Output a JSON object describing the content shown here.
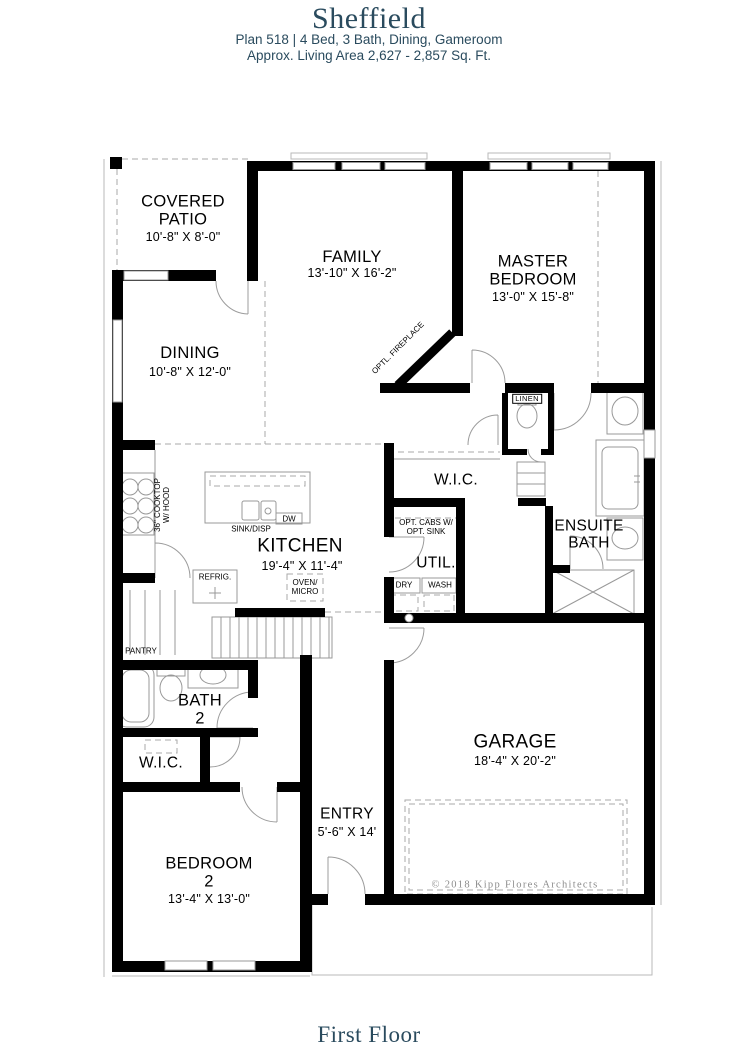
{
  "header": {
    "title": "Sheffield",
    "subtitle1": "Plan 518 | 4 Bed, 3 Bath, Dining, Gameroom",
    "subtitle2": "Approx. Living Area 2,627 - 2,857 Sq. Ft."
  },
  "footer": {
    "label": "First Floor"
  },
  "plan": {
    "copyright": "© 2018 Kipp Flores Architects",
    "colors": {
      "accent": "#2a4b5e",
      "wall": "#000000",
      "line": "#999999"
    },
    "rooms": {
      "covered_patio": {
        "name": "COVERED\nPATIO",
        "dims": "10'-8\" X 8'-0\""
      },
      "family": {
        "name": "FAMILY",
        "dims": "13'-10\" X 16'-2\""
      },
      "master": {
        "name": "MASTER\nBEDROOM",
        "dims": "13'-0\" X 15'-8\""
      },
      "dining": {
        "name": "DINING",
        "dims": "10'-8\" X 12'-0\""
      },
      "master_wic": {
        "name": "W.I.C."
      },
      "ensuite": {
        "name": "ENSUITE\nBATH"
      },
      "kitchen": {
        "name": "KITCHEN",
        "dims": "19'-4\" X 11'-4\""
      },
      "util": {
        "name": "UTIL."
      },
      "bath2": {
        "name": "BATH\n2"
      },
      "wic2": {
        "name": "W.I.C."
      },
      "bedroom2": {
        "name": "BEDROOM\n2",
        "dims": "13'-4\" X 13'-0\""
      },
      "entry": {
        "name": "ENTRY",
        "dims": "5'-6\" X 14'"
      },
      "garage": {
        "name": "GARAGE",
        "dims": "18'-4\" X 20'-2\""
      }
    },
    "fixtures": {
      "linen": "LINEN",
      "fireplace": "OPTL. FIREPLACE",
      "cooktop": "36\" COOKTOP\nW/ HOOD",
      "sink": "SINK/DISP",
      "dishwasher": "DW",
      "refrigerator": "REFRIG.",
      "oven": "OVEN/\nMICRO",
      "pantry": "PANTRY",
      "opt_cabs": "OPT. CABS W/\nOPT. SINK",
      "dryer": "DRY",
      "washer": "WASH"
    }
  }
}
